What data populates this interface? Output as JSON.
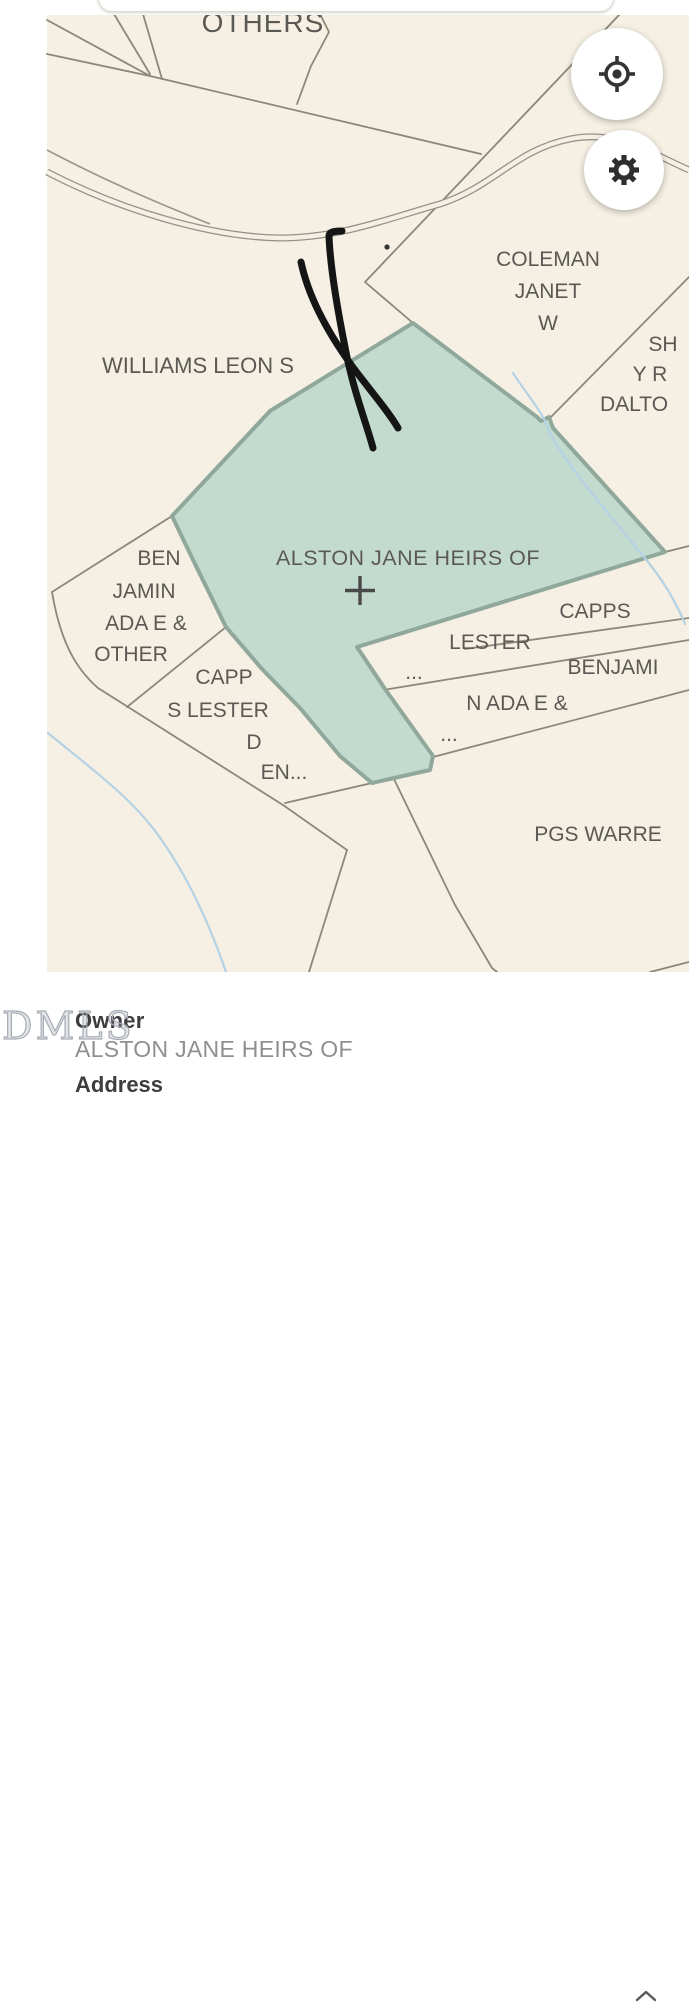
{
  "map": {
    "background_color": "#f5f0e3",
    "line_color": "#8d8779",
    "road_color": "#97918a",
    "water_color": "#b5d2e4",
    "annotation_color": "#151515",
    "selected_parcel": {
      "name": "ALSTON JANE HEIRS OF",
      "fill_color": "#bfd9cc",
      "border_color": "#8fa89b"
    },
    "labels": {
      "others": "OTHERS",
      "williams": "WILLIAMS LEON S",
      "coleman1": "COLEMAN",
      "coleman2": "JANET",
      "coleman3": "W",
      "dalton1": "SH",
      "dalton2": "Y R",
      "dalton3": "DALTO",
      "alston": "ALSTON JANE HEIRS OF",
      "benjamin1": "BEN",
      "benjamin2": "JAMIN",
      "benjamin3": "ADA E &",
      "benjamin4": "OTHER",
      "capps_l1": "CAPP",
      "capps_l2": "S LESTER",
      "capps_l3": "D",
      "capps_l4": "EN...",
      "capps_r": "CAPPS",
      "lester_r": "LESTER",
      "ellipsis1": "...",
      "benjamin_r1": "BENJAMI",
      "benjamin_r2": "N ADA E &",
      "ellipsis2": "...",
      "pgs": "PGS WARRE"
    }
  },
  "controls": {
    "locate_icon": "gps-crosshair",
    "settings_icon": "gear"
  },
  "watermark": "DMLS",
  "panel": {
    "owner_label": "Owner",
    "owner_value": "ALSTON JANE HEIRS OF",
    "next_section_label": "Address",
    "collapse_icon": "chevron-up"
  }
}
